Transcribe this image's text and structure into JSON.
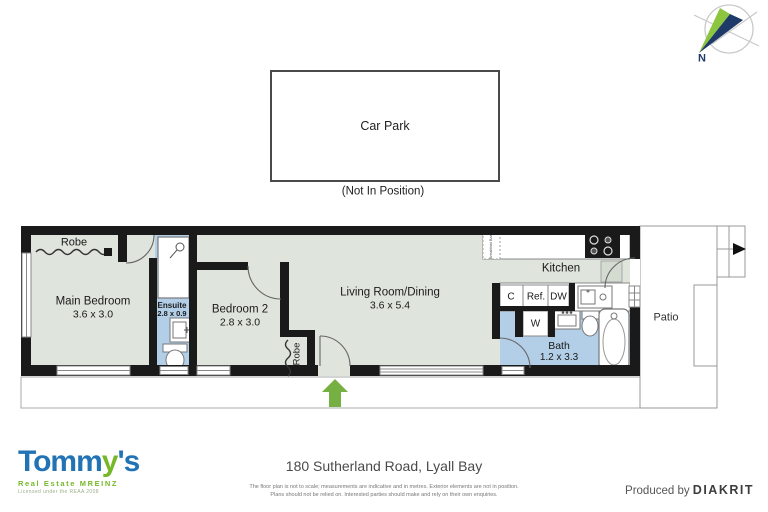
{
  "compass": {
    "north_label": "N"
  },
  "car_park": {
    "label": "Car Park",
    "note": "(Not In Position)"
  },
  "plan": {
    "main_bedroom_name": "Main Bedroom",
    "main_bedroom_dims": "3.6 x 3.0",
    "robe_main_label": "Robe",
    "ensuite_name": "Ensuite",
    "ensuite_dims": "2.8 x 0.9",
    "bedroom2_name": "Bedroom 2",
    "bedroom2_dims": "2.8 x 3.0",
    "robe2_label": "Robe",
    "living_name": "Living Room/Dining",
    "living_dims": "3.6 x 5.4",
    "kitchen_name": "Kitchen",
    "breakfast_bar_label": "Breakfast Bar",
    "bath_name": "Bath",
    "bath_dims": "1.2 x 3.3",
    "patio_name": "Patio",
    "cupboard_label": "C",
    "fridge_label": "Ref.",
    "dishwasher_label": "DW",
    "washer_label": "W"
  },
  "footer": {
    "address": "180 Sutherland Road, Lyall Bay",
    "disclaimer_line1": "The floor plan is not to scale; measurements are indicative and in metres. Exterior elements are not in position.",
    "disclaimer_line2": "Plans should not be relied on. Interested parties should make and rely on their own enquiries.",
    "produced_by": "Produced by ",
    "producer": "DIAKRIT",
    "brand_part1": "Tomm",
    "brand_part2": "y",
    "brand_part3": "'s",
    "brand_sub": "Real Estate MREINZ",
    "brand_license": "Licensed under the REAA 2008"
  },
  "colors": {
    "floor": "#dfe5dc",
    "wet_area": "#b3cfe8",
    "wall": "#1a1a1a",
    "entry_arrow": "#76b043",
    "brand_blue": "#2173b5",
    "brand_green": "#76b82a",
    "compass_navy": "#1e3a68"
  }
}
